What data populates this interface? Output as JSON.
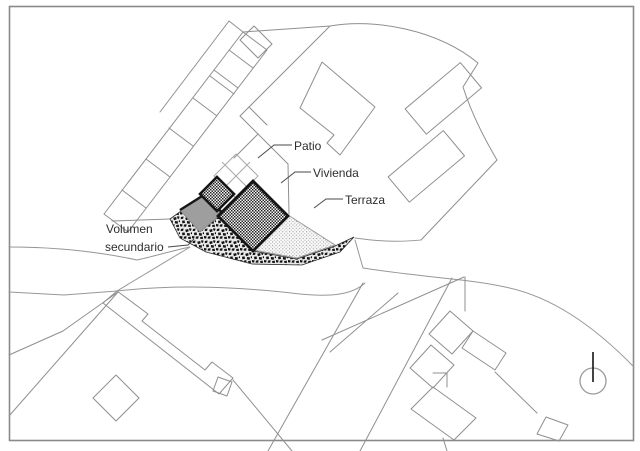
{
  "drawing": {
    "type": "architectural-site-plan",
    "background": "#ffffff",
    "labels": {
      "patio": "Patio",
      "vivienda": "Vivienda",
      "terraza": "Terraza",
      "volumen_line1": "Volumen",
      "volumen_line2": "secundario"
    },
    "colors": {
      "thin_line": "#8f8f8f",
      "thick_outline": "#161616",
      "text": "#2e2e2e",
      "secondary_volume_fill": "#9e9e9e",
      "frame_stroke": "#8a8a8a",
      "background": "#ffffff"
    },
    "icons": {
      "north_indicator": "circle-with-needle"
    }
  }
}
